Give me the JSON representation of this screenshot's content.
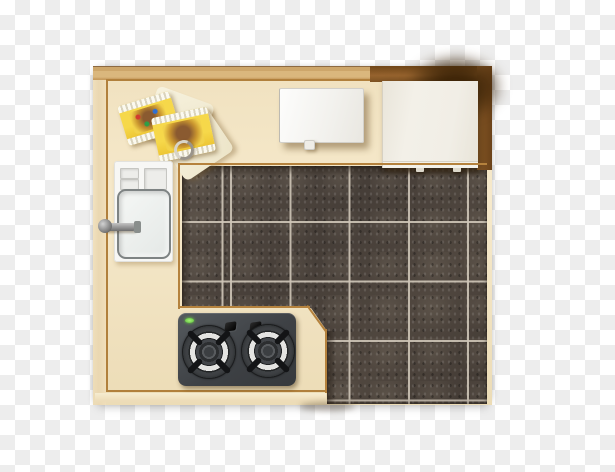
{
  "scene": {
    "kind": "stock-image-preview",
    "subject": "kitchen-top-view",
    "background": "transparency-checkerboard",
    "text_content": "none"
  },
  "objects": {
    "countertop": "L-shaped cream kitchen countertop",
    "tile_floor": "dark marble tile floor with light grout grid",
    "wood_trim": "dark wood band at top-right",
    "cabinet_top": "white cabinet / refrigerator top",
    "cutting_board": "white board on top counter",
    "sink_unit": "white sink with drainboard trays",
    "faucet": "chrome faucet handle",
    "gas_stove": "dark two-burner gas cooktop",
    "burner_count": 2,
    "knob_count": 2,
    "indicator_led": "green",
    "snack_package_count": 2,
    "dish_cloth": "cream cloth under packages",
    "metal_ring": "small metal ring"
  },
  "colors": {
    "checker_light": "#ffffff",
    "checker_dark": "#ededed",
    "counter_cream": "#f4e7c8",
    "counter_band_tan": "#d3ab6f",
    "trim_line": "#b5823d",
    "wood_dark": "#7c4f21",
    "tile_base": "#49413a",
    "tile_grout": "#cfc6b8",
    "stove_body": "#46494d",
    "stove_led_green": "#6fdc43",
    "sink_white": "#f7f7f5",
    "package_yellow": "#f2ce3a",
    "shadow_smudge": "#382106"
  }
}
